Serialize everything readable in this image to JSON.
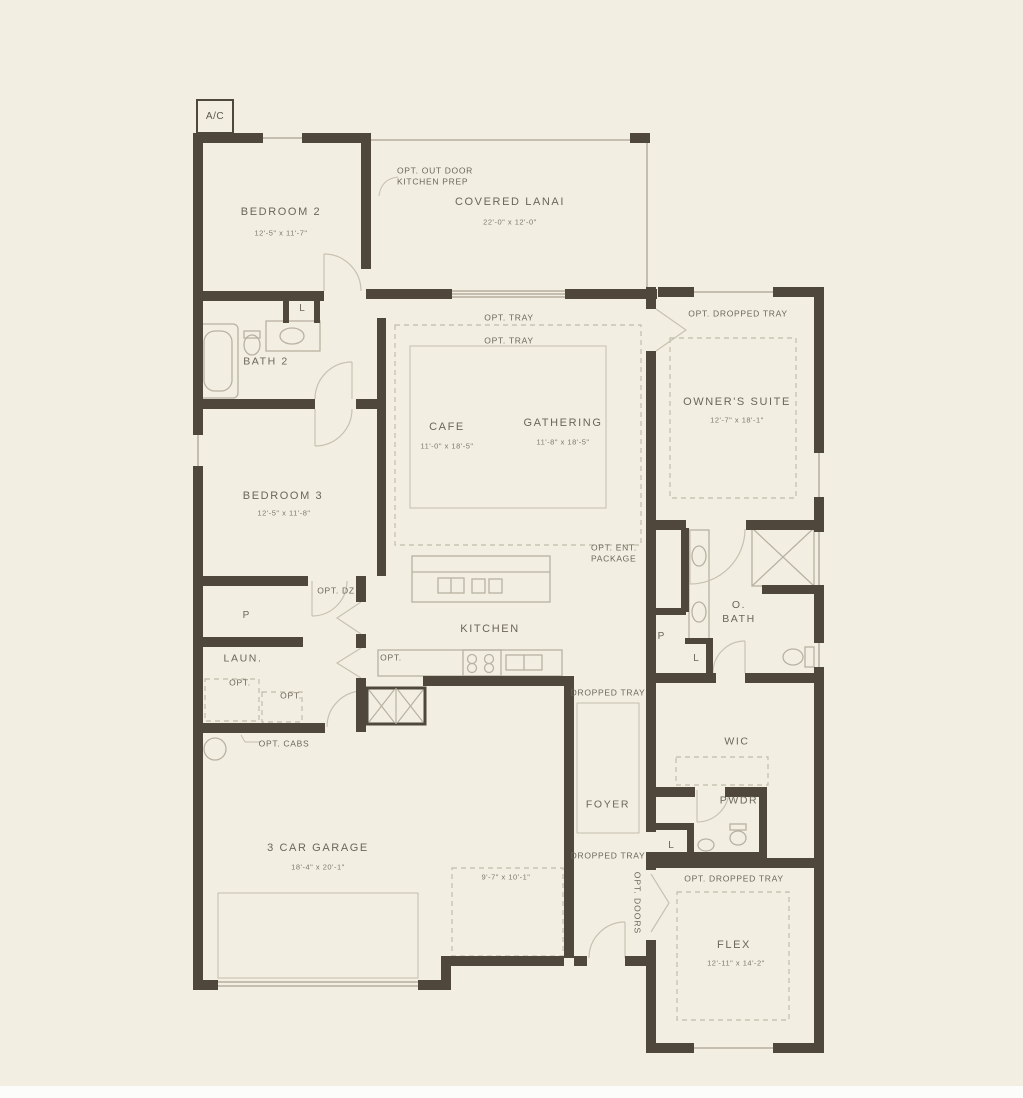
{
  "plan": {
    "ac_label": "A/C",
    "rooms": [
      {
        "id": "bedroom-2",
        "name": "BEDROOM 2",
        "dims": "12'-5\" x 11'-7\""
      },
      {
        "id": "covered-lanai",
        "name": "COVERED LANAI",
        "dims": "22'-0\" x 12'-0\""
      },
      {
        "id": "cafe",
        "name": "CAFE",
        "dims": "11'-0\" x 18'-5\""
      },
      {
        "id": "gathering",
        "name": "GATHERING",
        "dims": "11'-8\" x 18'-5\""
      },
      {
        "id": "owners-suite",
        "name": "OWNER'S SUITE",
        "dims": "12'-7\" x 18'-1\""
      },
      {
        "id": "bath-2",
        "name": "BATH 2",
        "dims": ""
      },
      {
        "id": "bedroom-3",
        "name": "BEDROOM 3",
        "dims": "12'-5\" x 11'-8\""
      },
      {
        "id": "kitchen",
        "name": "KITCHEN",
        "dims": ""
      },
      {
        "id": "laundry",
        "name": "LAUN.",
        "dims": ""
      },
      {
        "id": "owners-bath",
        "name": "O.\nBATH",
        "dims": ""
      },
      {
        "id": "wic",
        "name": "WIC",
        "dims": ""
      },
      {
        "id": "powder",
        "name": "PWDR",
        "dims": ""
      },
      {
        "id": "foyer",
        "name": "FOYER",
        "dims": ""
      },
      {
        "id": "flex",
        "name": "FLEX",
        "dims": "12'-11\" x 14'-2\""
      },
      {
        "id": "garage",
        "name": "3 CAR GARAGE",
        "dims": "18'-4\" x 20'-1\""
      },
      {
        "id": "garage-bay",
        "name": "",
        "dims": "9'-7\" x 10'-1\""
      }
    ],
    "annotations": {
      "opt_outdoor": "OPT. OUT DOOR\nKITCHEN PREP",
      "opt_tray_a": "OPT. TRAY",
      "opt_tray_b": "OPT. TRAY",
      "opt_dropped_tray_owner": "OPT. DROPPED TRAY",
      "opt_ent_package": "OPT. ENT.\nPACKAGE",
      "opt_dz": "OPT. DZ",
      "pantry_p": "P",
      "hall_p": "P",
      "bath2_linen": "L",
      "hall_linen": "L",
      "foyer_linen": "L",
      "opt_laundry_left": "OPT.",
      "opt_laundry_right": "OPT.",
      "opt_kitchen": "OPT.",
      "opt_cabs": "OPT. CABS",
      "dropped_tray_upper": "DROPPED TRAY",
      "dropped_tray_lower": "DROPPED TRAY",
      "opt_dropped_tray_flex": "OPT. DROPPED TRAY",
      "opt_doors": "OPT. DOORS"
    },
    "colors": {
      "background": "#f2efe2",
      "wall": "#4f473c",
      "thin_line": "#b6ae9e",
      "door_arc": "#c9c1b0",
      "label_text": "#6c665a"
    }
  }
}
